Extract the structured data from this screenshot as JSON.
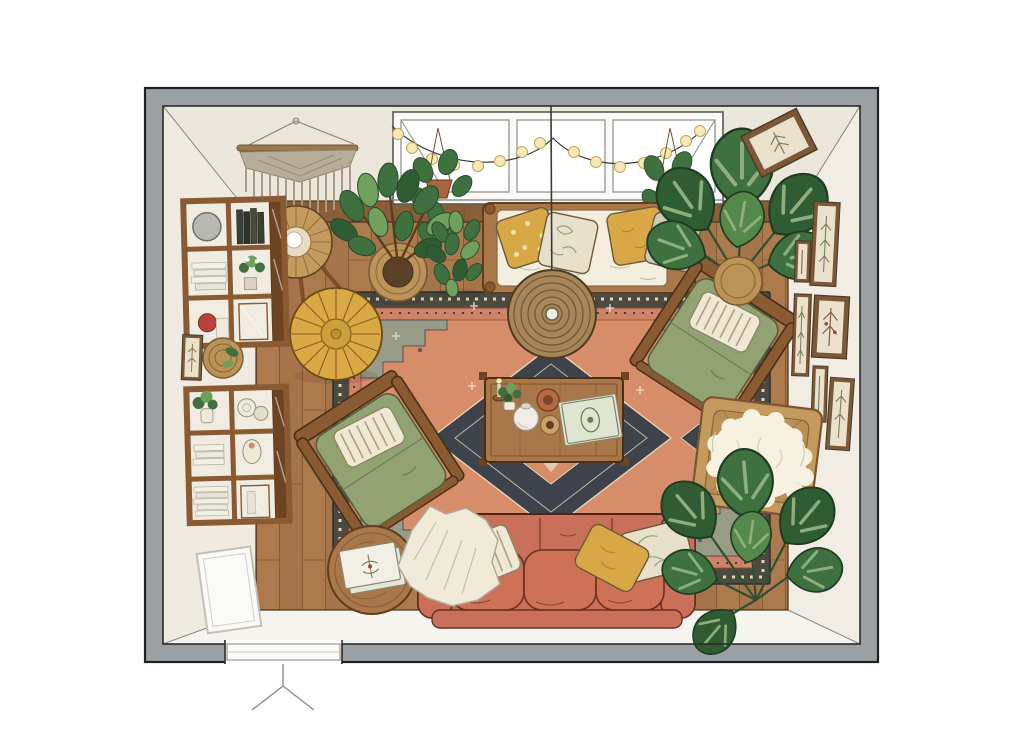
{
  "scene": {
    "type": "top-down interior illustration",
    "subject": "boho living room floor plan",
    "items": [
      {
        "name": "room-walls",
        "note": "gray plan walls with door opening bottom-left"
      },
      {
        "name": "door-opening",
        "note": "threshold with swing mark below bottom wall"
      },
      {
        "name": "window",
        "note": "three-pane window on top wall with tilted end sashes"
      },
      {
        "name": "string-lights",
        "note": "two sagging strands with warm bulbs",
        "bulb_count": 15
      },
      {
        "name": "macrame-wall-hanging",
        "note": "fringed hanging, top-left wall"
      },
      {
        "name": "hanging-plant-left",
        "note": "pothos in terracotta pot at window left"
      },
      {
        "name": "hanging-plant-right",
        "note": "pothos in terracotta pot at window right"
      },
      {
        "name": "fiddle-leaf-fig",
        "note": "large plant in woven basket, top-left"
      },
      {
        "name": "potted-plant",
        "note": "bushy green plant beside daybed"
      },
      {
        "name": "daybed",
        "note": "wood-frame bench with cream mattress and four pillows"
      },
      {
        "name": "pendant-light",
        "note": "woven rattan dome on cord, seen from above"
      },
      {
        "name": "persian-rug",
        "note": "salmon field, dark medallion, stepped corners"
      },
      {
        "name": "coffee-table",
        "note": "wood table with candle, plant, vase, bowls, books"
      },
      {
        "name": "moroccan-pouf",
        "note": "mustard leather pouf with radial stitching"
      },
      {
        "name": "floor-lamp",
        "note": "rattan cone shade on tripod legs, top-left"
      },
      {
        "name": "bookshelf-upper",
        "note": "wall shelf with mirror, books, red vase, flowers"
      },
      {
        "name": "bookshelf-lower",
        "note": "wall shelf with plants, ceramics, book stacks"
      },
      {
        "name": "left-wall-frame",
        "note": "small print between shelves"
      },
      {
        "name": "woven-wall-plate",
        "note": "round basket plate with sprig"
      },
      {
        "name": "armchair-top-right",
        "note": "sage green cushion, striped lumbar pillow"
      },
      {
        "name": "armchair-bottom-left",
        "note": "sage green cushion, striped lumbar pillow"
      },
      {
        "name": "rattan-chair",
        "note": "square rattan frame draped with sheepskin, right wall"
      },
      {
        "name": "terracotta-sofa",
        "note": "three-seat sofa with throw and three pillows, bottom"
      },
      {
        "name": "throw-blanket",
        "note": "cream blanket over sofa left arm"
      },
      {
        "name": "side-table",
        "note": "round wood table with two books, bottom-left"
      },
      {
        "name": "monstera-top-right",
        "note": "monstera in basket, top-right corner"
      },
      {
        "name": "monstera-bottom-right",
        "note": "monstera in bottom-right corner"
      },
      {
        "name": "gallery-frames",
        "note": "botanical prints on right wall",
        "frame_count": 6
      },
      {
        "name": "angled-frame",
        "note": "botanical print on top wall near right corner"
      },
      {
        "name": "leaning-panel",
        "note": "thin white frame leaning on left wall near door"
      }
    ]
  },
  "palette": {
    "background": "#ffffff",
    "wall": "#9aa0a3",
    "wall_line": "#2a2a28",
    "face_top": "#ece7db",
    "face_left": "#efebe1",
    "face_right": "#f1ede4",
    "face_bottom": "#f6f4ef",
    "wainscot": "#8a5e38",
    "floor": "#ad7a4e",
    "floor_alt": "#a6744a",
    "floor_line": "#7d5430",
    "rug_border": "#4b4a40",
    "rug_band": "#cf8366",
    "rug_field": "#d78c6a",
    "rug_accent": "#e3d5b4",
    "rug_medallion": "#3e424b",
    "rug_corner": "#989b85",
    "sofa": "#c9705a",
    "sofa_cushion": "#cd7257",
    "cushion_cream": "#f3eedd",
    "pillow_mustard": "#d8a847",
    "pillow_floral": "#e7e0cb",
    "pillow_stripe": "#efe8d2",
    "pillow_gray": "#cfc9b9",
    "chair_green": "#93a273",
    "wood": "#8a5a33",
    "wood_mid": "#a9784a",
    "pouf": "#d9a945",
    "pendant": "#a5855a",
    "basket": "#bb9257",
    "plant": "#3f7040",
    "plant_dark": "#2f5c33",
    "plant_light": "#6fa05c",
    "macrame": "#b7ad9b",
    "sheepskin": "#f6f1e1",
    "rattan": "#c49a5e",
    "frame_wood": "#7a5838",
    "frame_mat": "#eae2cd",
    "throw": "#f0ead9",
    "bulb": "#f5e9b8"
  }
}
